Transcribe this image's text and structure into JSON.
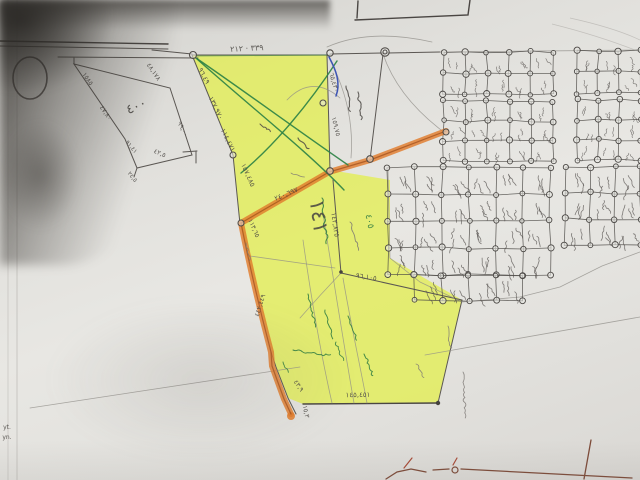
{
  "meta": {
    "description": "Photograph of a hand-drawn cadastral survey sketch: a large yellow-highlighted land parcel bordered by orange-highlighted roads, adjacent to a dense grid of small subdivision plots, with handwritten Arabic-Indic dimension figures",
    "colors": {
      "paper": "#e4e3df",
      "shadow": "#36332f",
      "highlight_yellow": "#e3ee52",
      "highlight_orange": "#e07c2d",
      "pen_green": "#2e8245",
      "pen_blue": "#3d55b4",
      "pencil": "#5b5753",
      "sketch_brown": "#7d4a38"
    }
  },
  "annotations": [
    {
      "text": "٣٣٩ · ٢١٢",
      "x": 247,
      "y": 51,
      "rot": -3,
      "size": 8,
      "color": "ink",
      "name": "top-edge-dimension"
    },
    {
      "text": "٩٦,٤٩",
      "x": 202,
      "y": 77,
      "rot": 62,
      "size": 7,
      "color": "ink",
      "name": "left-edge-dimension-1"
    },
    {
      "text": "١٣٧,٩٧٠",
      "x": 214,
      "y": 109,
      "rot": 64,
      "size": 7,
      "color": "ink",
      "name": "left-edge-dimension-2"
    },
    {
      "text": "١١٤,٤٧١",
      "x": 226,
      "y": 141,
      "rot": 64,
      "size": 7,
      "color": "ink",
      "name": "left-edge-dimension-3"
    },
    {
      "text": "١٥٧,٤٨٥",
      "x": 246,
      "y": 176,
      "rot": 66,
      "size": 7,
      "color": "ink",
      "name": "left-edge-dimension-4"
    },
    {
      "text": "٦٥,٤٣٠",
      "x": 332,
      "y": 83,
      "rot": 74,
      "size": 6.5,
      "color": "ink",
      "name": "right-edge-dimension-1"
    },
    {
      "text": "١٥٩,٧٥",
      "x": 334,
      "y": 127,
      "rot": 76,
      "size": 6.5,
      "color": "ink",
      "name": "right-edge-dimension-2"
    },
    {
      "text": "٢٤٠,٦٩٧",
      "x": 287,
      "y": 196,
      "rot": -23,
      "size": 7,
      "color": "ink",
      "name": "diagonal-road-dimension"
    },
    {
      "text": "١١٣,٦٥",
      "x": 252,
      "y": 229,
      "rot": 66,
      "size": 6.5,
      "color": "ink",
      "name": "inner-edge-dimension"
    },
    {
      "text": "١٤٢,٨٣٥",
      "x": 333,
      "y": 225,
      "rot": 82,
      "size": 7,
      "color": "ink",
      "name": "parcel-line-dimension"
    },
    {
      "text": "٩٦,١٠٥",
      "x": 366,
      "y": 279,
      "rot": 9,
      "size": 7,
      "color": "ink",
      "name": "lower-line-dimension"
    },
    {
      "text": "١٤٥,٤٥١",
      "x": 358,
      "y": 397,
      "rot": -1,
      "size": 7,
      "color": "ink",
      "name": "bottom-edge-dimension"
    },
    {
      "text": "٤٣,٩",
      "x": 297,
      "y": 387,
      "rot": 56,
      "size": 6.5,
      "color": "ink",
      "name": "jog-dimension-1"
    },
    {
      "text": "١٥,٣",
      "x": 304,
      "y": 412,
      "rot": 78,
      "size": 6.5,
      "color": "ink",
      "name": "jog-dimension-2"
    },
    {
      "text": "٤٤٢,٤٤٩",
      "x": 262,
      "y": 306,
      "rot": -73,
      "size": 6.5,
      "color": "ink",
      "name": "west-road-dimension"
    },
    {
      "text": "١٤١",
      "x": 312,
      "y": 217,
      "rot": 82,
      "size": 21,
      "color": "ink",
      "name": "parcel-number"
    },
    {
      "text": "٤٠٥",
      "x": 367,
      "y": 222,
      "rot": 78,
      "size": 9,
      "color": "green",
      "name": "green-figure"
    },
    {
      "text": "١٥٨٥",
      "x": 86,
      "y": 80,
      "rot": 56,
      "size": 6.5,
      "color": "ink",
      "name": "pentagon-edge-1"
    },
    {
      "text": "٤٧,٨٠",
      "x": 104,
      "y": 114,
      "rot": 56,
      "size": 6.5,
      "color": "ink",
      "name": "pentagon-edge-2"
    },
    {
      "text": "٤٠٠",
      "x": 138,
      "y": 110,
      "rot": -25,
      "size": 13,
      "color": "ink",
      "name": "pentagon-area-figure"
    },
    {
      "text": "٤٨,١٧٨",
      "x": 152,
      "y": 73,
      "rot": 56,
      "size": 6.5,
      "color": "ink",
      "name": "pentagon-edge-3"
    },
    {
      "text": "٩٩,٠٠",
      "x": 181,
      "y": 130,
      "rot": 62,
      "size": 6.5,
      "color": "ink",
      "name": "pentagon-edge-4"
    },
    {
      "text": "٤٢,٥",
      "x": 159,
      "y": 155,
      "rot": 24,
      "size": 6.5,
      "color": "ink",
      "name": "pentagon-edge-5"
    },
    {
      "text": "٩١,٤١",
      "x": 130,
      "y": 148,
      "rot": 50,
      "size": 6,
      "color": "ink",
      "name": "pentagon-edge-6"
    },
    {
      "text": "٢٤,٥",
      "x": 131,
      "y": 178,
      "rot": 50,
      "size": 6,
      "color": "ink",
      "name": "pentagon-tail-figure"
    },
    {
      "text": "yt.",
      "x": 7,
      "y": 429,
      "rot": 0,
      "size": 6,
      "color": "ink",
      "name": "edge-fragment-1"
    },
    {
      "text": "yn.",
      "x": 7,
      "y": 439,
      "rot": 0,
      "size": 6,
      "color": "ink",
      "name": "edge-fragment-2"
    }
  ],
  "scribbles": [
    {
      "x": 346,
      "y": 86,
      "len": 26,
      "ang": 80,
      "color": "ink",
      "w": 1.1
    },
    {
      "x": 358,
      "y": 92,
      "len": 28,
      "ang": 82,
      "color": "ink",
      "w": 1.1
    },
    {
      "x": 298,
      "y": 138,
      "len": 16,
      "ang": 45,
      "color": "ink",
      "w": 1.1
    },
    {
      "x": 260,
      "y": 124,
      "len": 13,
      "ang": 35,
      "color": "ink",
      "w": 1.0
    },
    {
      "x": 322,
      "y": 198,
      "len": 46,
      "ang": 84,
      "color": "green",
      "w": 1.1
    },
    {
      "x": 350,
      "y": 222,
      "len": 30,
      "ang": 72,
      "color": "pencil",
      "w": 0.9
    },
    {
      "x": 308,
      "y": 294,
      "len": 34,
      "ang": 76,
      "color": "green",
      "w": 1.0
    },
    {
      "x": 325,
      "y": 310,
      "len": 30,
      "ang": 74,
      "color": "green",
      "w": 1.0
    },
    {
      "x": 348,
      "y": 316,
      "len": 26,
      "ang": 70,
      "color": "green",
      "w": 1.0
    },
    {
      "x": 293,
      "y": 350,
      "len": 38,
      "ang": 8,
      "color": "green",
      "w": 1.0
    },
    {
      "x": 364,
      "y": 354,
      "len": 24,
      "ang": 66,
      "color": "green",
      "w": 1.0
    },
    {
      "x": 336,
      "y": 342,
      "len": 20,
      "ang": 70,
      "color": "green",
      "w": 0.9
    },
    {
      "x": 283,
      "y": 362,
      "len": 12,
      "ang": 60,
      "color": "green",
      "w": 0.9
    },
    {
      "x": 463,
      "y": 372,
      "len": 46,
      "ang": 88,
      "color": "pencil",
      "w": 0.8
    },
    {
      "x": 448,
      "y": 326,
      "len": 22,
      "ang": 82,
      "color": "pencil",
      "w": 0.8
    },
    {
      "x": 246,
      "y": 243,
      "len": 18,
      "ang": 76,
      "color": "pencil",
      "w": 0.8
    },
    {
      "x": 291,
      "y": 173,
      "len": 14,
      "ang": 20,
      "color": "pencil",
      "w": 0.8
    },
    {
      "x": 416,
      "y": 364,
      "len": 16,
      "ang": 60,
      "color": "pencil",
      "w": 0.8
    }
  ],
  "parcel_grid": {
    "blocks": [
      {
        "x": 443,
        "y": 52,
        "cw": 22,
        "ch": 21,
        "cols": 5,
        "rows": 2
      },
      {
        "x": 577,
        "y": 51,
        "cw": 21,
        "ch": 21,
        "cols": 3,
        "rows": 2
      },
      {
        "x": 443,
        "y": 101,
        "cw": 22,
        "ch": 20,
        "cols": 5,
        "rows": 3
      },
      {
        "x": 577,
        "y": 100,
        "cw": 21,
        "ch": 20,
        "cols": 3,
        "rows": 3
      },
      {
        "x": 388,
        "y": 167,
        "cw": 27,
        "ch": 27,
        "cols": 6,
        "rows": 4
      },
      {
        "x": 415,
        "y": 275,
        "cw": 27,
        "ch": 25,
        "cols": 4,
        "rows": 1
      },
      {
        "x": 565,
        "y": 167,
        "cw": 25,
        "ch": 26,
        "cols": 3,
        "rows": 3
      }
    ]
  }
}
